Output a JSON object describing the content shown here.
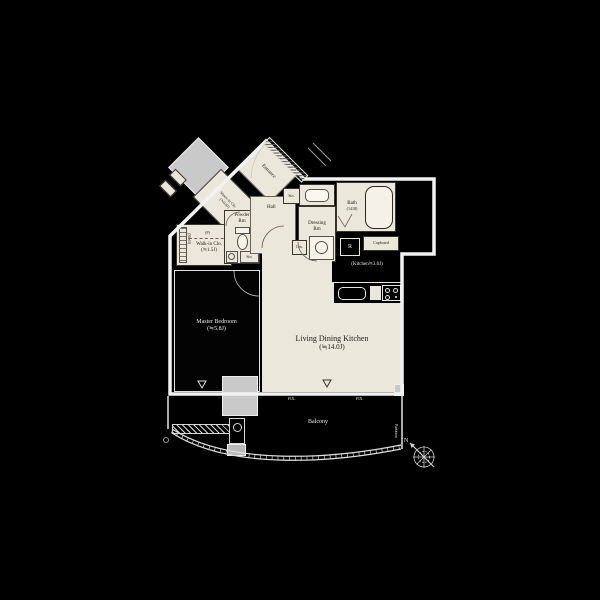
{
  "colors": {
    "background": "#000000",
    "room_fill": "#ece7db",
    "wall": "#f2f2f2",
    "shaft_gray": "#c9c9c9",
    "text_dark": "#1d1a16",
    "text_light": "#e9e9e9"
  },
  "plan": {
    "entrance": {
      "label": "Entrance"
    },
    "shoes_closet": {
      "label": "Shoes-in Clo.",
      "size": "(≒0.8J)"
    },
    "walkin_closet": {
      "label": "Walk-in Clo.",
      "size": "(≒1.5J)",
      "shelf_left": "(Shelf)",
      "shelf_top": "(Shelf)",
      "pole": "(P)"
    },
    "powder_room": {
      "line1": "Powder",
      "line2": "Rm",
      "storage": "Sto."
    },
    "hall": {
      "label": "Hall",
      "storage": "Sto."
    },
    "dressing_room": {
      "line1": "Dressing",
      "line2": "Rm",
      "linen": "Lin."
    },
    "bath": {
      "label": "Bath",
      "size": "(1418)"
    },
    "kitchen": {
      "label": "(Kitchen≒3.0J)",
      "cupboard": "Cupboard",
      "refrigerator": "R"
    },
    "ldk": {
      "label": "Living Dining Kitchen",
      "size": "(≒14.0J)"
    },
    "bedroom": {
      "label": "Master Bedroom",
      "size": "(≒5.8J)"
    },
    "balcony": {
      "label": "Balcony",
      "partition": "Partition",
      "fix_left": "FIX.",
      "fix_right": "FIX."
    },
    "compass": {
      "north": "N"
    }
  }
}
